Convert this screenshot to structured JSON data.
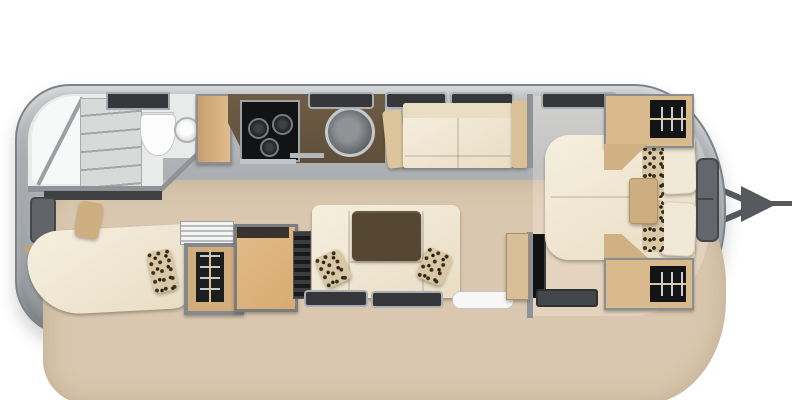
{
  "colors": {
    "shell_border": "#7e8286",
    "wall": "#8f9397",
    "floor": "#d9c7af",
    "bath_floor": "#e9ebea",
    "cream": "#f3ecda",
    "wood": "#d9ba8c",
    "wood_trim": "#c9a268",
    "counter": "#5f4f3a",
    "table": "#564733",
    "dark": "#17181a",
    "silver": "#c2c5c8",
    "window": "#35373a",
    "hitch": "#56595d",
    "leopard_base": "#d8c8a5",
    "leopard_spot": "#3a2d1a",
    "tan_pillow": "#cdae80"
  },
  "legend": {
    "trailer": "Travel trailer floor plan, top view",
    "hitch": "Front hitch / A-frame tongue",
    "shower": "Corner shower",
    "shelving": "Bathroom shelving",
    "toilet": "Toilet",
    "bath_sink": "Bathroom sink",
    "vent": "Roof vent hatch",
    "rear_bed": "Rear curved bed",
    "rear_window": "Rear window",
    "wardrobe": "Wardrobe with hanging clothes",
    "accordion": "Tambour vent",
    "fridge": "Refrigerator cabinet",
    "slat_panel": "Louvered panel",
    "counter": "Galley counter",
    "stove": "Three-burner cooktop",
    "kitchen_sink": "Round kitchen sink",
    "utensil_rail": "Counter rail",
    "sofa": "Side sofa",
    "armrest": "Sofa armrest",
    "dinette": "Dinette lounge",
    "table": "Dinette table",
    "pillow_leopard": "Leopard accent pillow",
    "pillow_tan": "Tan accent pillow",
    "pillow_cream": "Bed pillow",
    "entry_step": "Entry door step",
    "window": "Window",
    "partition": "Bedroom partition wall",
    "cabinet": "Cabinet",
    "tv": "TV panel",
    "mat": "Bedroom floor mat",
    "bed": "Front queen bed",
    "console": "Front console"
  }
}
